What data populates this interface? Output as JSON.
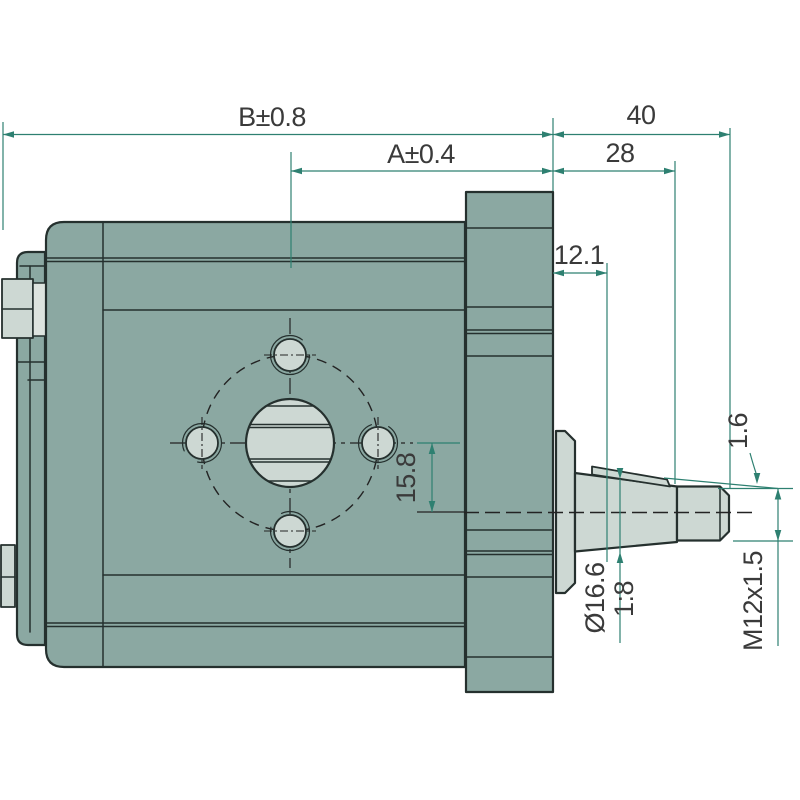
{
  "drawing_type": "gear-pump-side-view-technical-drawing",
  "colors": {
    "bg": "#ffffff",
    "body": "#8ba8a2",
    "light": "#cdd8d3",
    "lighter": "#dde4df",
    "outline": "#25302e",
    "centerline": "#232323",
    "dim": "#2e8071",
    "text": "#3a3a3a"
  },
  "dimensions": [
    {
      "id": "overall-length",
      "label": "B±0.8",
      "orientation": "horizontal"
    },
    {
      "id": "body-length",
      "label": "A±0.4",
      "orientation": "horizontal"
    },
    {
      "id": "shaft-end-length",
      "label": "40",
      "orientation": "horizontal"
    },
    {
      "id": "shaft-taper-length",
      "label": "28",
      "orientation": "horizontal"
    },
    {
      "id": "gauge-plane-distance",
      "label": "12.1",
      "orientation": "horizontal"
    },
    {
      "id": "axis-offset",
      "label": "15.8",
      "orientation": "vertical"
    },
    {
      "id": "taper-gauge-diameter",
      "label": "Ø16.6",
      "orientation": "vertical"
    },
    {
      "id": "taper-ratio",
      "label": "1:8",
      "orientation": "vertical"
    },
    {
      "id": "key-protrusion",
      "label": "1.6",
      "orientation": "vertical"
    },
    {
      "id": "thread-spec",
      "label": "M12x1.5",
      "orientation": "vertical"
    }
  ]
}
